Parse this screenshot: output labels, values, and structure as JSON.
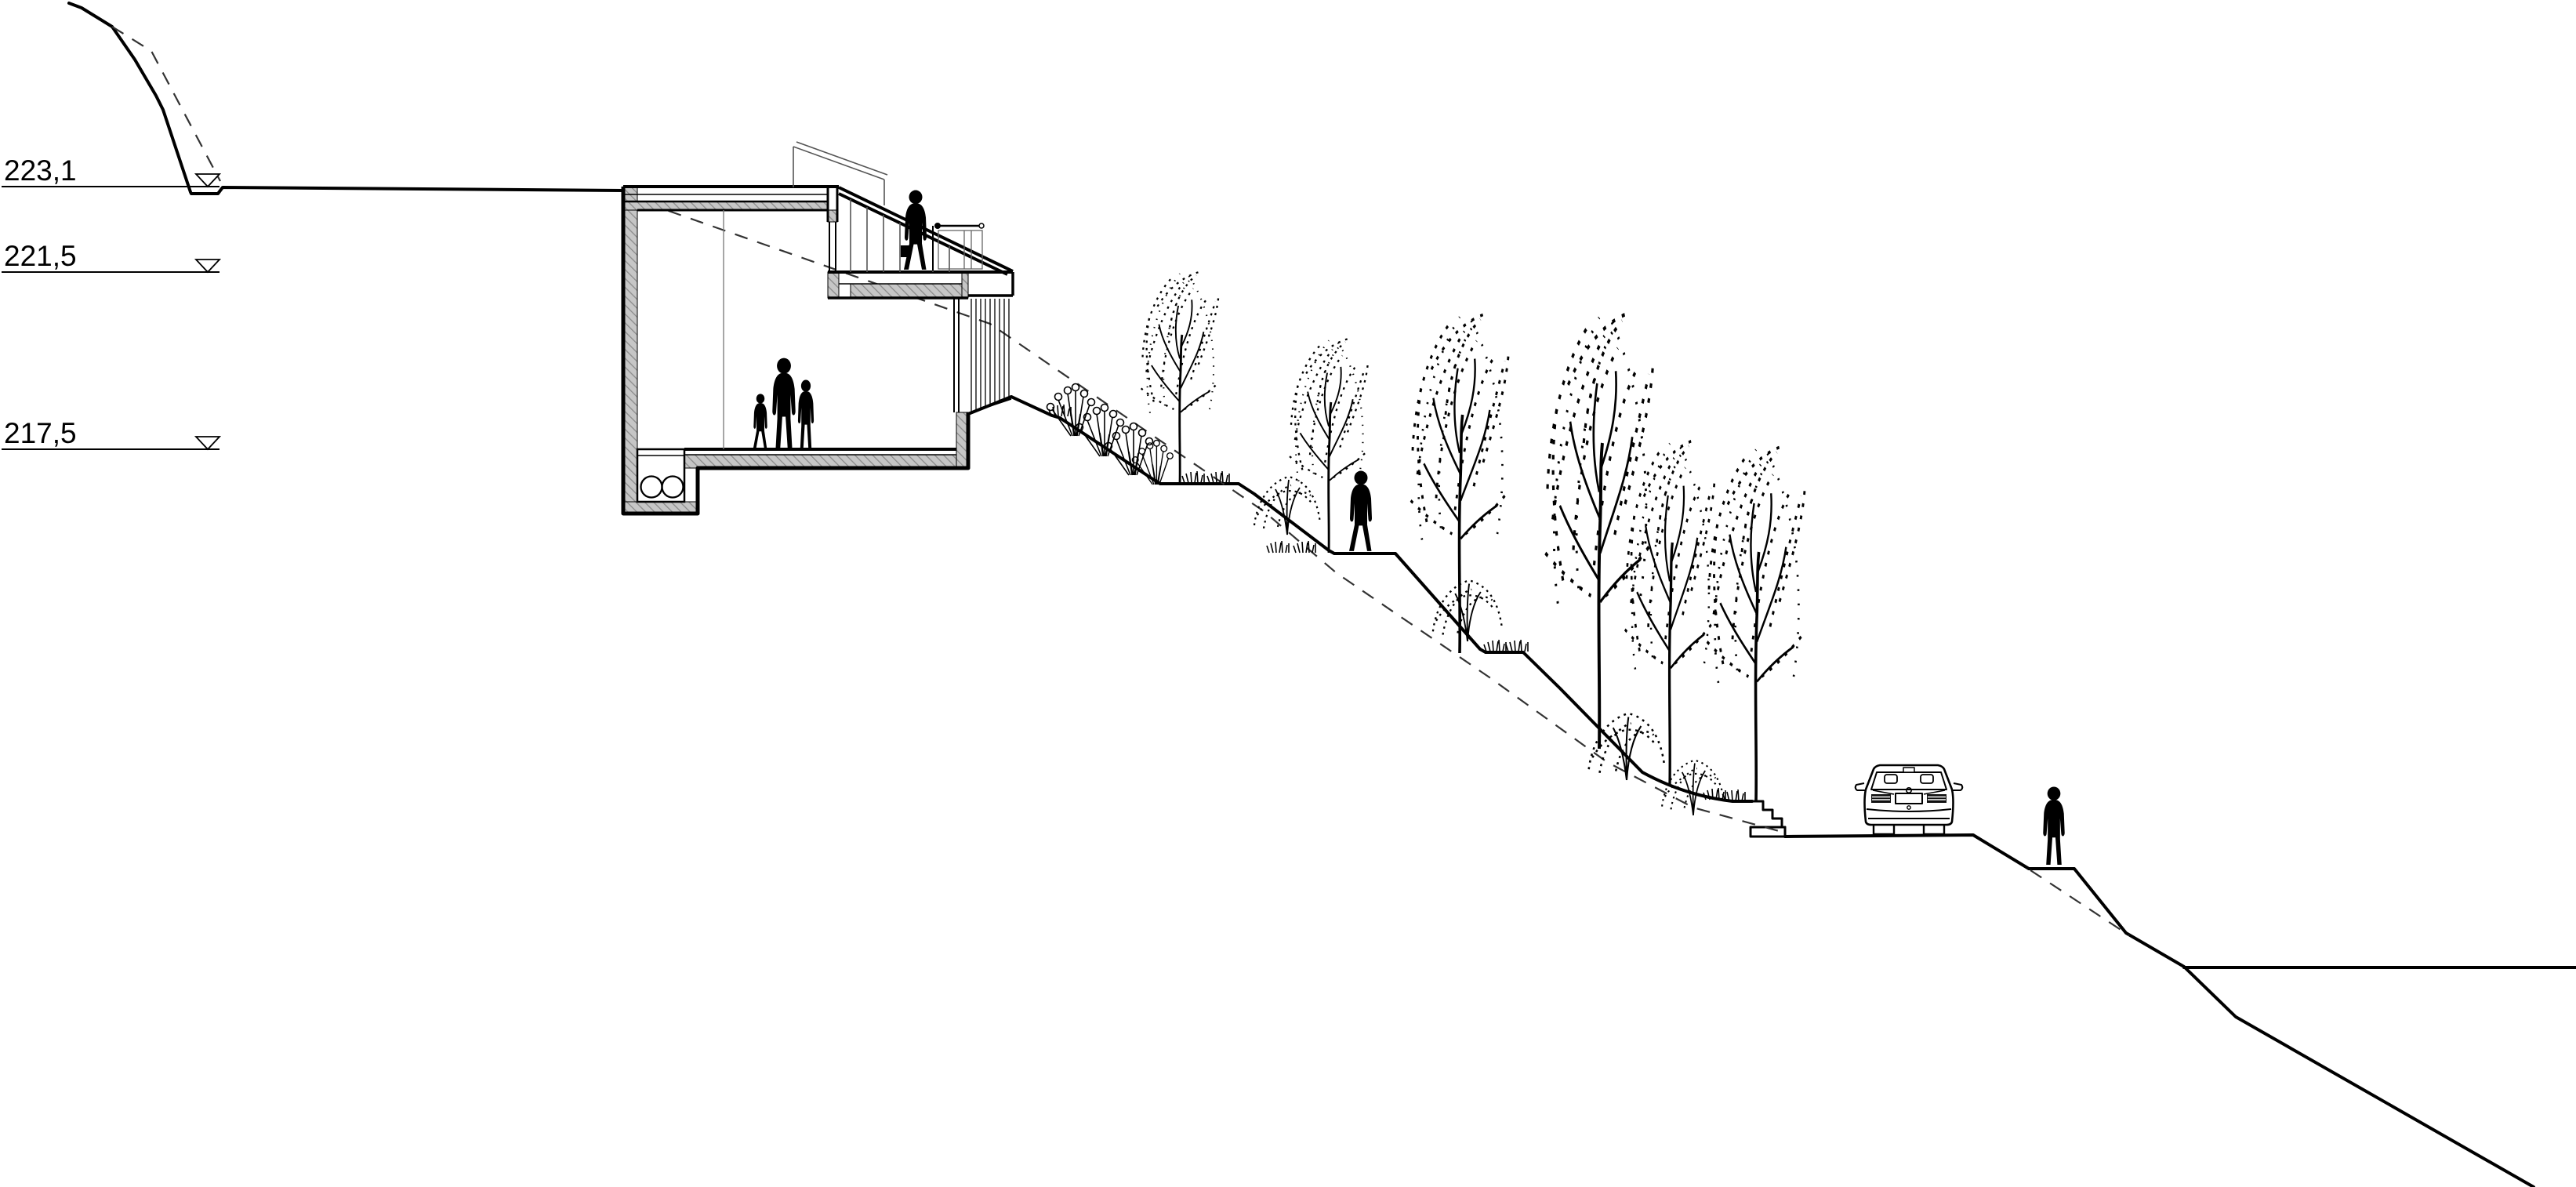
{
  "drawing": {
    "background_color": "#ffffff",
    "line_color": "#000000",
    "wall_hatch_color": "#c6c6c6",
    "hatch_line_color": "#8b8b8b"
  },
  "elevation_markers": [
    {
      "label": "223,1"
    },
    {
      "label": "221,5"
    },
    {
      "label": "217,5"
    }
  ],
  "scene": {
    "house": "sectioned-hillside-house-with-roof-terrace",
    "grade_line": "dashed-existing-grade-line",
    "terrain": [
      "upper-plateau",
      "stepped-slope",
      "garden-stairs",
      "road",
      "lower-slope",
      "lower-plateau"
    ],
    "figures": [
      "family-in-living-room",
      "person-on-terrace",
      "person-walking-slope",
      "person-walking-road"
    ],
    "vehicle": "car-rear-view",
    "vegetation": [
      "poplar-trees",
      "bushes",
      "wildflowers",
      "grass-tufts"
    ]
  }
}
